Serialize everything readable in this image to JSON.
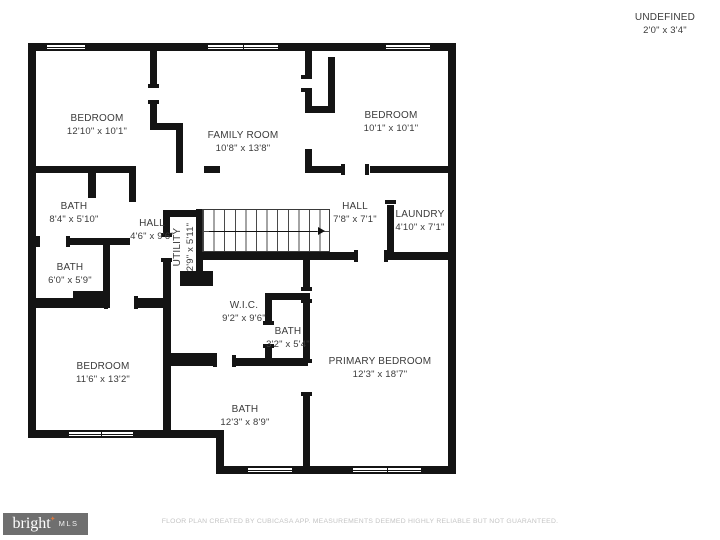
{
  "undefined_space": {
    "name": "UNDEFINED",
    "dims": "2'0\" x 3'4\""
  },
  "rooms": {
    "bedroom_top_left": {
      "name": "BEDROOM",
      "dims": "12'10\" x 10'1\""
    },
    "family_room": {
      "name": "FAMILY ROOM",
      "dims": "10'8\" x 13'8\""
    },
    "bedroom_top_right": {
      "name": "BEDROOM",
      "dims": "10'1\" x 10'1\""
    },
    "bath_upper_left": {
      "name": "BATH",
      "dims": "8'4\" x 5'10\""
    },
    "hall_left": {
      "name": "HALL",
      "dims": "4'6\" x 9'6\""
    },
    "hall_right": {
      "name": "HALL",
      "dims": "7'8\" x 7'1\""
    },
    "laundry": {
      "name": "LAUNDRY",
      "dims": "4'10\" x 7'1\""
    },
    "bath_mid_left": {
      "name": "BATH",
      "dims": "6'0\" x 5'9\""
    },
    "utility": {
      "name": "UTILITY",
      "dims": "2'9\" x 5'11\""
    },
    "wic": {
      "name": "W.I.C.",
      "dims": "9'2\" x 9'6\""
    },
    "bath_small": {
      "name": "BATH",
      "dims": "3'2\" x 5'4\""
    },
    "bedroom_bottom_left": {
      "name": "BEDROOM",
      "dims": "11'6\" x 13'2\""
    },
    "primary_bedroom": {
      "name": "PRIMARY BEDROOM",
      "dims": "12'3\" x 18'7\""
    },
    "bath_bottom": {
      "name": "BATH",
      "dims": "12'3\" x 8'9\""
    }
  },
  "footer": {
    "logo_text": "bright",
    "logo_star": "✦",
    "logo_suffix": "MLS",
    "disclaimer": "FLOOR PLAN CREATED BY CUBICASA APP. MEASUREMENTS DEEMED HIGHLY RELIABLE BUT NOT GUARANTEED."
  },
  "colors": {
    "wall": "#141414",
    "label": "#3b3b3b",
    "disclaimer": "#c4c4c4",
    "logo_bg": "#6f6f6f",
    "logo_star_color": "#d97941"
  }
}
